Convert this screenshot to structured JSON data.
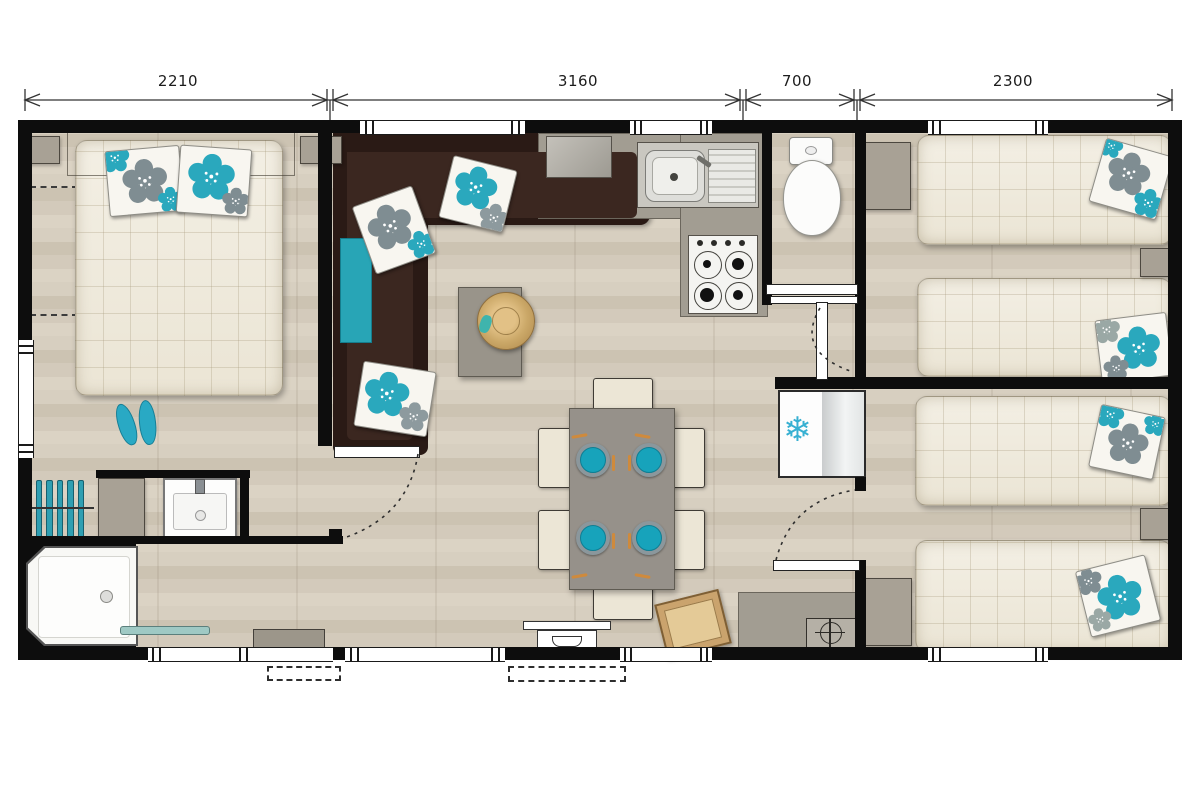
{
  "dimension_bar": {
    "unit": "mm",
    "segments": [
      {
        "label": "2210"
      },
      {
        "label": "3160"
      },
      {
        "label": "700"
      },
      {
        "label": "2300"
      }
    ]
  },
  "icons": {
    "snowflake_glyph": "❄",
    "flower_icon": "five-petal-flower",
    "boiler_symbol": "circle-with-cross"
  },
  "colors": {
    "accent_teal": "#2aa8bd",
    "sofa_brown": "#2d1b15",
    "wall_black": "#0d0d0d",
    "floor_beige": "#d3cabb",
    "mattress_cream": "#f1ecdf",
    "counter_gray": "#a29d92"
  }
}
